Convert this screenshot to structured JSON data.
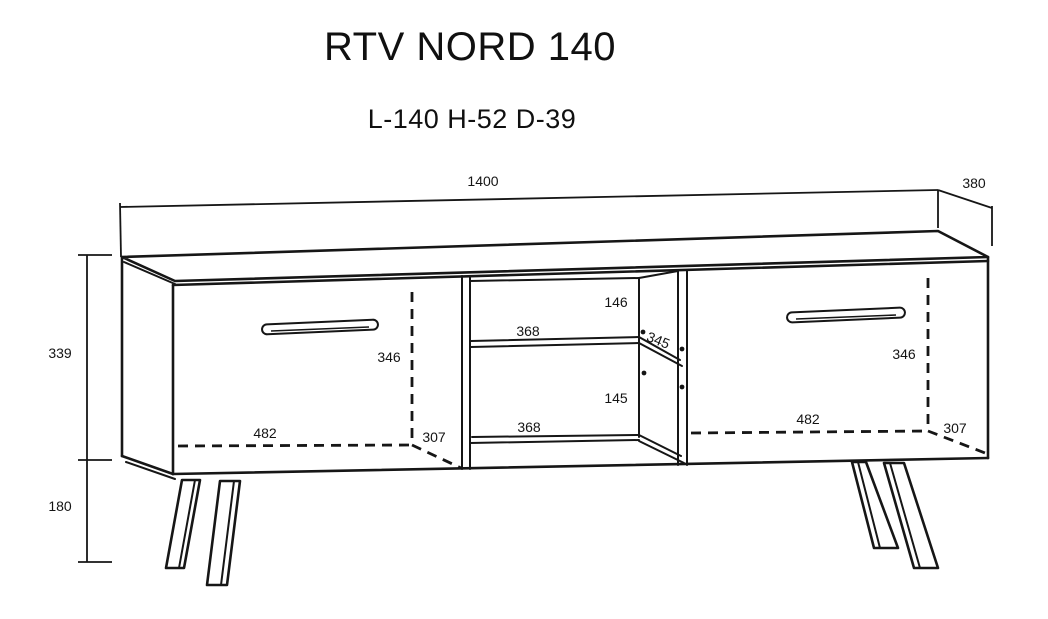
{
  "page": {
    "title": "RTV NORD 140",
    "subtitle": "L-140 H-52 D-39"
  },
  "diagram": {
    "product": "TV stand technical drawing",
    "colors": {
      "line": "#161616",
      "background": "#ffffff",
      "text": "#141414"
    },
    "dimensions": {
      "overall_width_mm": "1400",
      "overall_depth_mm": "380",
      "carcass_height_mm": "339",
      "leg_height_mm": "180"
    },
    "left_door": {
      "inner_height_mm": "346",
      "inner_width_mm": "482",
      "inner_depth_mm": "307"
    },
    "right_door": {
      "inner_height_mm": "346",
      "inner_width_mm": "482",
      "inner_depth_mm": "307"
    },
    "open_section": {
      "upper_compartment": {
        "height_mm": "146",
        "width_mm": "368"
      },
      "lower_compartment": {
        "height_mm": "145",
        "width_mm": "368"
      },
      "shelf_depth_mm": "345"
    }
  }
}
